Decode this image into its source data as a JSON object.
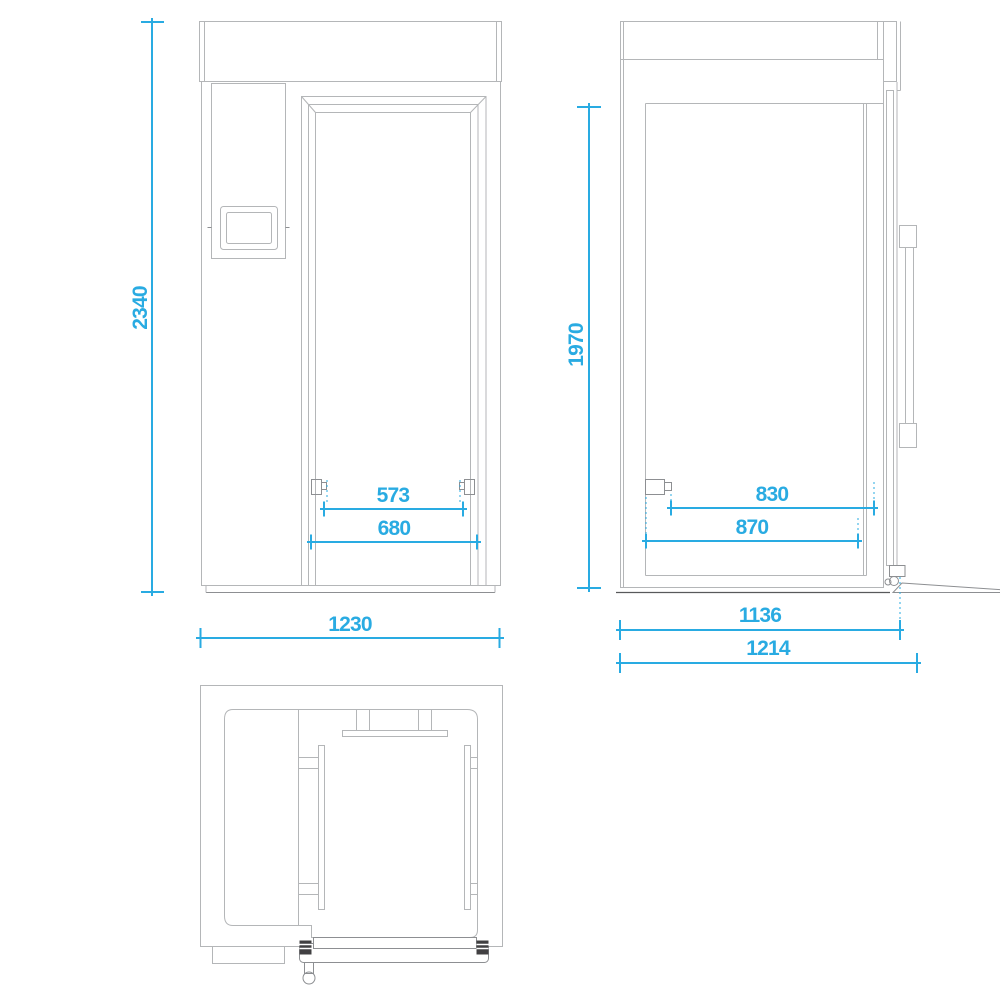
{
  "drawing": {
    "title": "Cold room three-view technical drawing",
    "background": "#ffffff",
    "colors": {
      "dimension_accent": "#29abe2",
      "outline_light": "#b4b6b8",
      "outline_medium": "#8d8f92",
      "outline_dark": "#58595b",
      "hinge_fill": "#414042"
    },
    "views": {
      "front": {
        "name": "front-elevation",
        "dims": {
          "overall_height": "2340",
          "overall_width": "1230",
          "door_opening_width": "573",
          "door_frame_width": "680"
        }
      },
      "side": {
        "name": "side-elevation",
        "dims": {
          "door_height": "1970",
          "upper_depth": "830",
          "lower_depth": "870",
          "body_depth": "1136",
          "overall_depth": "1214"
        }
      },
      "plan": {
        "name": "top-plan-view"
      }
    }
  }
}
